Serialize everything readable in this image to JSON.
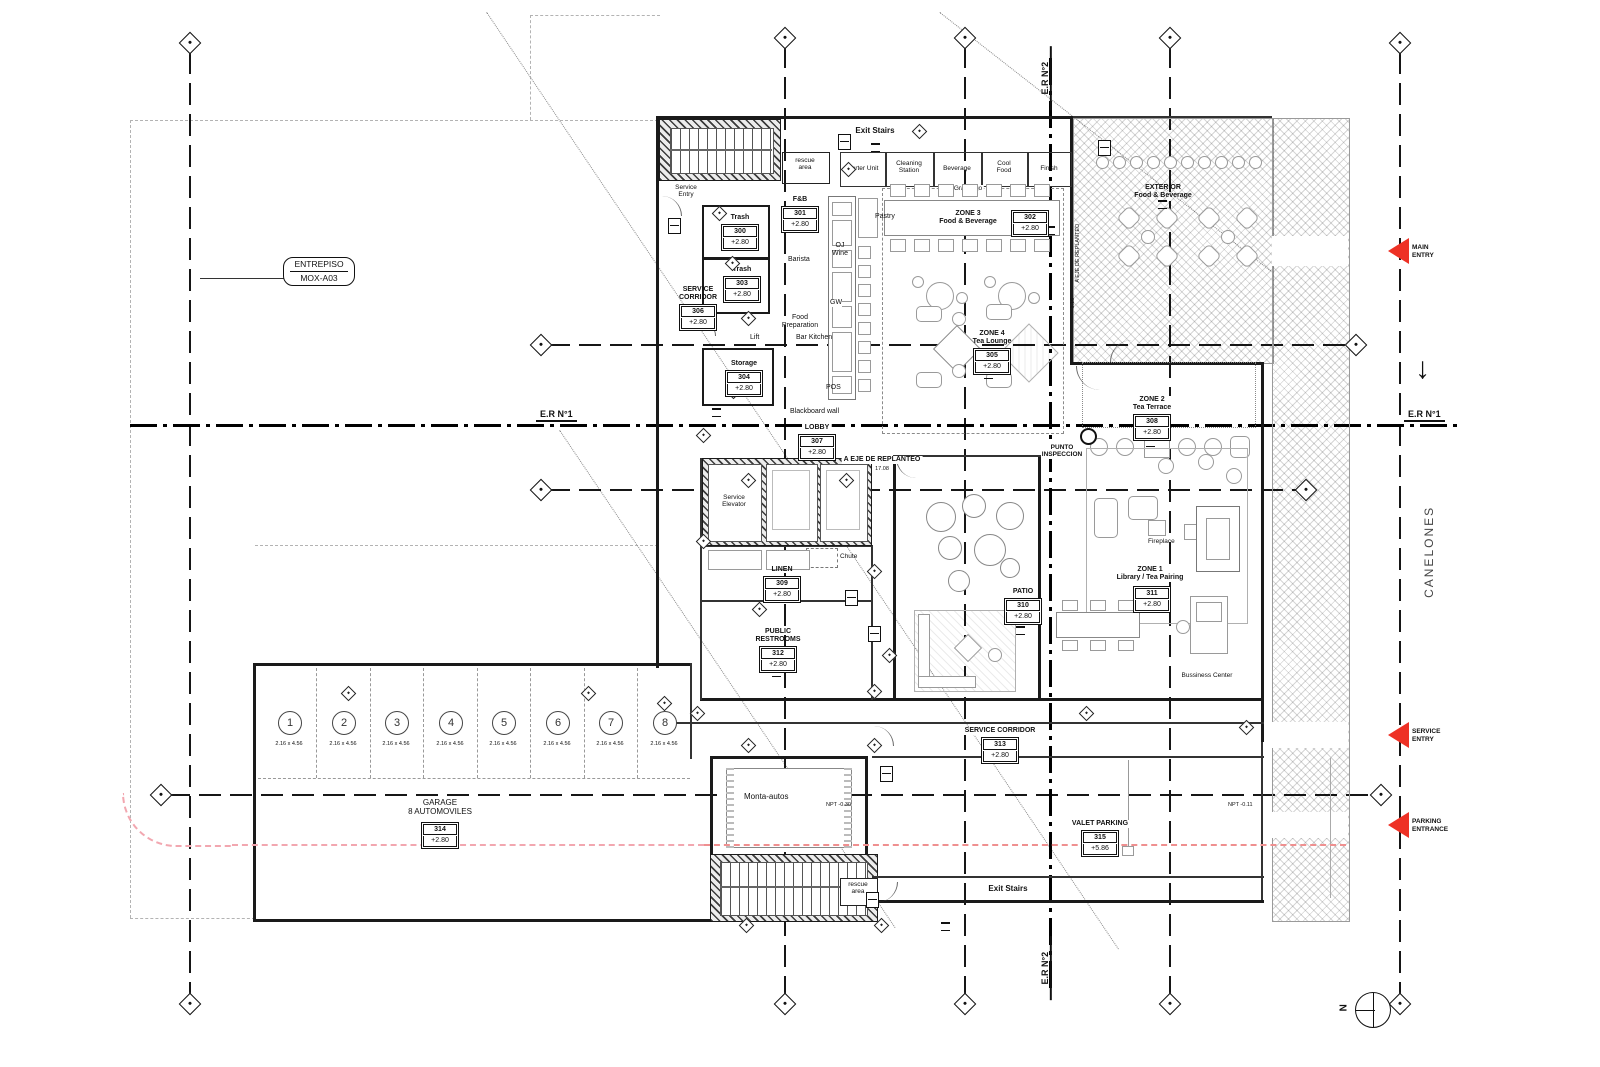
{
  "plan": {
    "title_box": {
      "line1": "ENTREPISO",
      "line2": "MOX-A03"
    },
    "axes": {
      "er1": "E.R N°1",
      "er2": "E.R N°2"
    },
    "street": {
      "name": "CANELONES"
    },
    "compass": {
      "north": "N"
    },
    "entries": {
      "main_l1": "MAIN",
      "main_l2": "ENTRY",
      "service_l1": "SERVICE",
      "service_l2": "ENTRY",
      "parking_l1": "PARKING",
      "parking_l2": "ENTRANCE"
    }
  },
  "stations": {
    "starter": "Starter Unit",
    "cleaning_l1": "Cleaning",
    "cleaning_l2": "Station",
    "beverage": "Beverage",
    "cool_l1": "Cool",
    "cool_l2": "Food",
    "finish": "Finish"
  },
  "kitchen": {
    "pastry": "Pastry",
    "oj_l1": "OJ",
    "oj_l2": "Wine",
    "barista": "Barista",
    "gw": "GW",
    "pos": "POS",
    "lift": "Lift",
    "food_prep_l1": "Food",
    "food_prep_l2": "Preparation",
    "bar_kitchen": "Bar Kitchen",
    "blackboard": "Blackboard wall",
    "grab": "Grab n'go"
  },
  "labels": {
    "service_entry_l1": "Service",
    "service_entry_l2": "Entry",
    "exit_stairs": "Exit Stairs",
    "rescue_l1": "rescue",
    "rescue_l2": "area",
    "service_elevator_l1": "Service",
    "service_elevator_l2": "Elevator",
    "chute": "Chute",
    "fireplace": "Fireplace",
    "business_center": "Bussiness Center",
    "punto_l1": "PUNTO",
    "punto_l2": "INSPECCION",
    "monta_autos": "Monta-autos",
    "npt_030": "NPT -0.30",
    "npt_011": "NPT -0.11",
    "eje_replanteo": "A EJE DE REPLANTEO",
    "eje_dim": "17.08",
    "eje_dim2": "1.16"
  },
  "rooms": {
    "trash_a": {
      "name": "Trash",
      "tag": "300",
      "level": "+2.80"
    },
    "fnb": {
      "name": "F&B",
      "tag": "301",
      "level": "+2.80"
    },
    "zone3": {
      "name": "ZONE 3",
      "sub": "Food & Beverage",
      "tag": "302",
      "level": "+2.80"
    },
    "trash_b": {
      "name": "Trash",
      "tag": "303",
      "level": "+2.80"
    },
    "storage": {
      "name": "Storage",
      "tag": "304",
      "level": "+2.80"
    },
    "zone4": {
      "name": "ZONE 4",
      "sub": "Tea Lounge",
      "tag": "305",
      "level": "+2.80"
    },
    "service_corridor_a": {
      "name": "SERVICE",
      "name2": "CORRIDOR",
      "tag": "306",
      "level": "+2.80"
    },
    "lobby": {
      "name": "LOBBY",
      "tag": "307",
      "level": "+2.80"
    },
    "zone2": {
      "name": "ZONE 2",
      "sub": "Tea Terrace",
      "tag": "308",
      "level": "+2.80"
    },
    "linen": {
      "name": "LINEN",
      "tag": "309",
      "level": "+2.80"
    },
    "patio": {
      "name": "PATIO",
      "tag": "310",
      "level": "+2.80"
    },
    "zone1": {
      "name": "ZONE 1",
      "sub": "Library / Tea Pairing",
      "tag": "311",
      "level": "+2.80"
    },
    "restrooms": {
      "name": "PUBLIC",
      "name2": "RESTROOMS",
      "tag": "312",
      "level": "+2.80"
    },
    "service_corridor_b": {
      "name": "SERVICE CORRIDOR",
      "tag": "313",
      "level": "+2.80"
    },
    "garage": {
      "name": "GARAGE",
      "sub": "8 AUTOMOVILES",
      "tag": "314",
      "level": "+2.80"
    },
    "valet": {
      "name": "VALET PARKING",
      "tag": "315",
      "level": "+5.86"
    },
    "exterior": {
      "name": "EXTERIOR",
      "sub": "Food & Beverage"
    }
  },
  "parking": {
    "size": "2.16 x 4.56",
    "stalls": [
      "1",
      "2",
      "3",
      "4",
      "5",
      "6",
      "7",
      "8"
    ]
  }
}
